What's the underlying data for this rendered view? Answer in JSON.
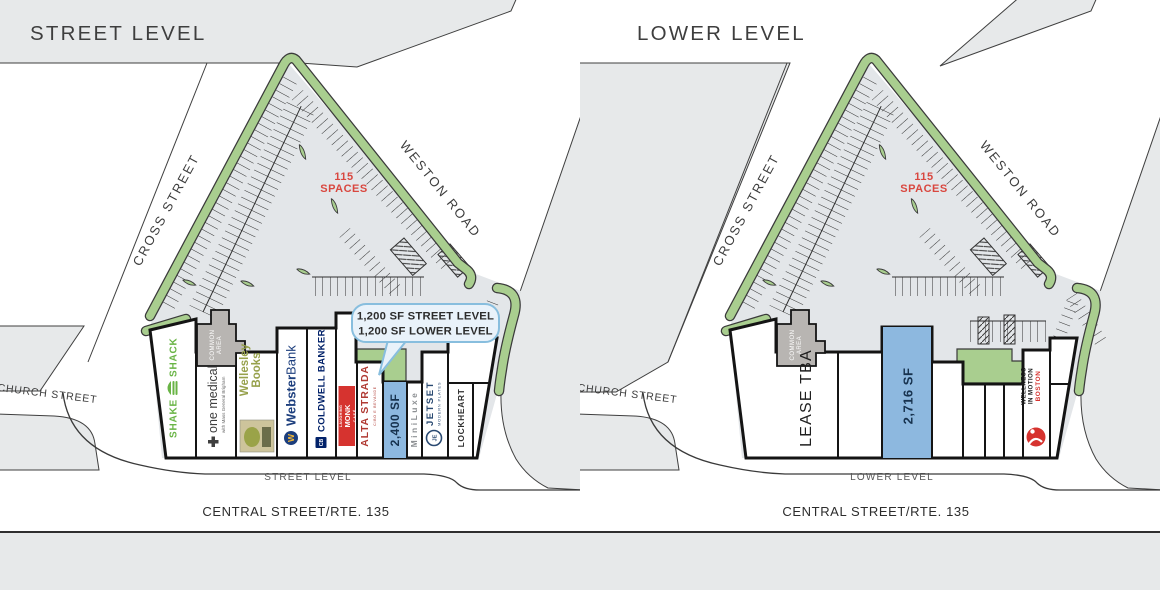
{
  "street_panel": {
    "title": "STREET LEVEL",
    "level_label": "STREET LEVEL",
    "roads": {
      "cross": "CROSS STREET",
      "weston": "WESTON ROAD",
      "church": "CHURCH STREET",
      "central": "CENTRAL STREET/RTE. 135"
    },
    "parking": {
      "count": "115",
      "label": "SPACES"
    },
    "callout": {
      "line1": "1,200 SF STREET LEVEL",
      "line2": "1,200 SF LOWER LEVEL"
    },
    "common_area": {
      "line1": "COMMON",
      "line2": "AREA"
    },
    "tenants": {
      "shake_shack": {
        "word1": "SHAKE",
        "word2": "SHACK"
      },
      "one_medical": {
        "name": "one medical",
        "sub": "with Mass General Brigham"
      },
      "wellesley_books": {
        "line1": "Wellesley",
        "line2": "Books"
      },
      "webster_bank": {
        "bold": "Webster",
        "light": "Bank",
        "monogram": "W"
      },
      "coldwell_banker": {
        "name": "COLDWELL BANKER",
        "monogram": "CB"
      },
      "laughing_monk": {
        "line1": "LAUGHING",
        "line2": "MONK",
        "line3": "C A F É"
      },
      "alta_strada": {
        "name": "ALTA STRADA",
        "sub": "CIBO E BEVANDE"
      },
      "unit_2400": {
        "label": "2,400 SF"
      },
      "miniluxe": {
        "name": "MiniLuxe"
      },
      "jetset": {
        "line1": "JETSET",
        "line2": "MODERN PLATES",
        "monogram": "JE"
      },
      "lockheart": {
        "name": "LOCKHEART"
      }
    }
  },
  "lower_panel": {
    "title": "LOWER LEVEL",
    "level_label": "LOWER LEVEL",
    "roads": {
      "cross": "CROSS STREET",
      "weston": "WESTON ROAD",
      "church": "CHURCH STREET",
      "central": "CENTRAL STREET/RTE. 135"
    },
    "parking": {
      "count": "115",
      "label": "SPACES"
    },
    "common_area": {
      "line1": "COMMON",
      "line2": "AREA"
    },
    "tenants": {
      "lease_tba": {
        "label": "LEASE TBA"
      },
      "unit_2716": {
        "label": "2,716 SF"
      },
      "wellness": {
        "line1": "WELLNESS",
        "line2": "IN MOTION",
        "line3": "BOSTON"
      }
    }
  },
  "colors": {
    "landscape_green": "#a9ce8f",
    "available_blue": "#8db8df",
    "accent_red": "#d9473f",
    "parcel_gray": "#e7e9ea"
  }
}
